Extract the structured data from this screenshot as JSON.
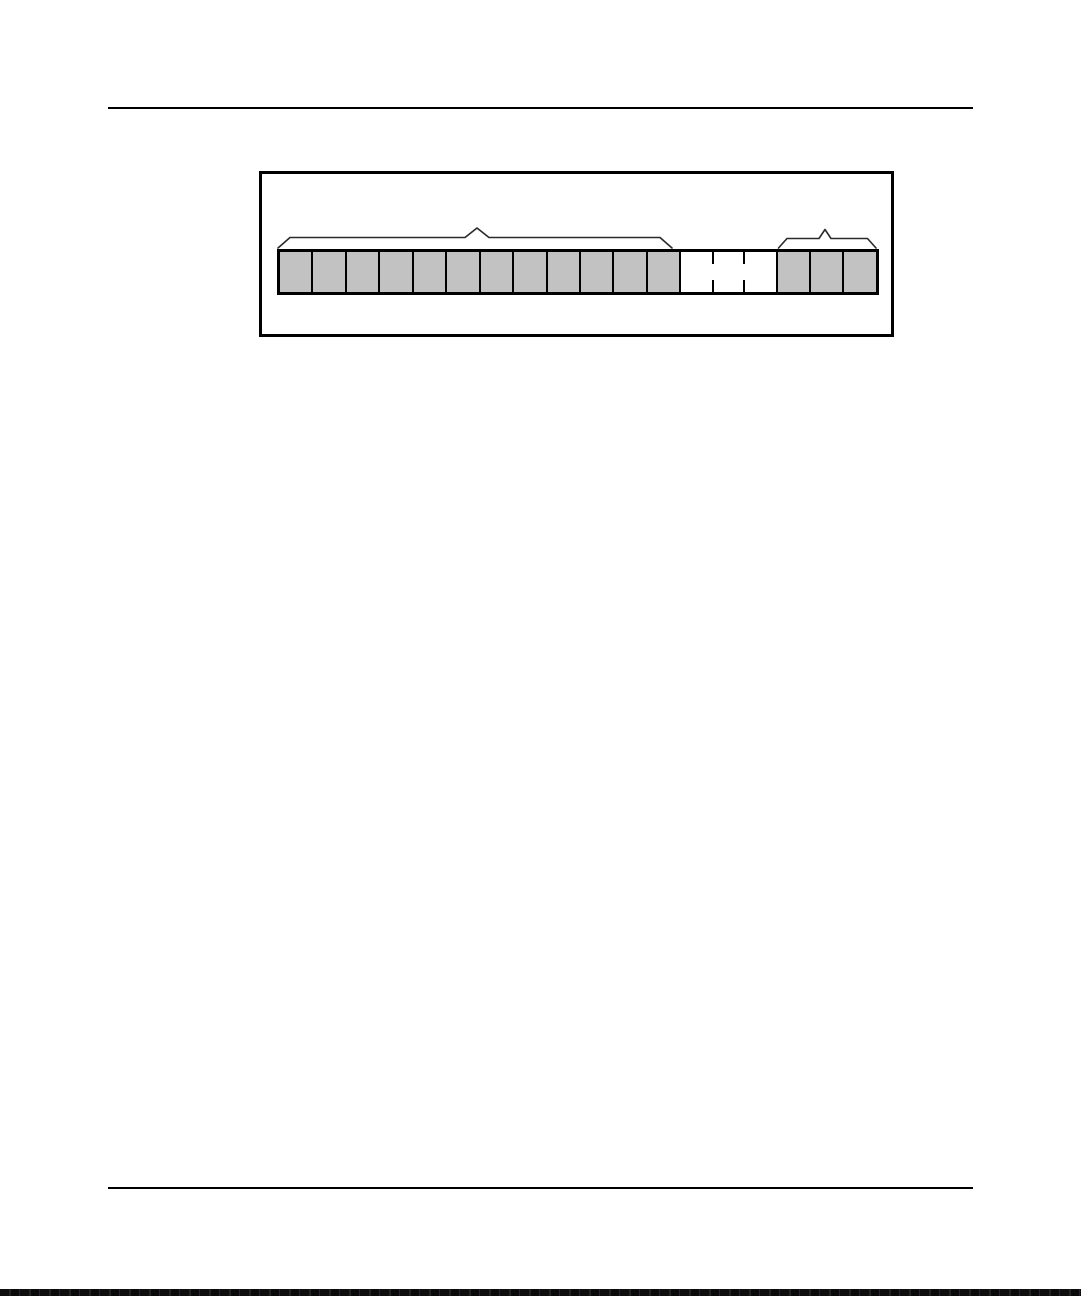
{
  "page": {
    "background_color": "#ffffff",
    "rule_color": "#000000"
  },
  "figure": {
    "frame_border_color": "#000000",
    "cell_row": {
      "outline_color": "#000000",
      "shaded_fill": "#c2c2c2",
      "empty_fill": "#ffffff",
      "cells": [
        "shaded",
        "shaded",
        "shaded",
        "shaded",
        "shaded",
        "shaded",
        "shaded",
        "shaded",
        "shaded",
        "shaded",
        "shaded",
        "shaded",
        "empty",
        "empty-dashed",
        "empty-dashed",
        "shaded",
        "shaded",
        "shaded"
      ],
      "left_shaded_group_count": 12,
      "middle_empty_group_count": 3,
      "right_shaded_group_count": 3
    },
    "braces": {
      "color": "#2a2a2a",
      "left_brace_spans_cells": 12,
      "right_brace_spans_cells": 3
    }
  },
  "scan_artifact": {
    "color": "#0e0e0e"
  }
}
